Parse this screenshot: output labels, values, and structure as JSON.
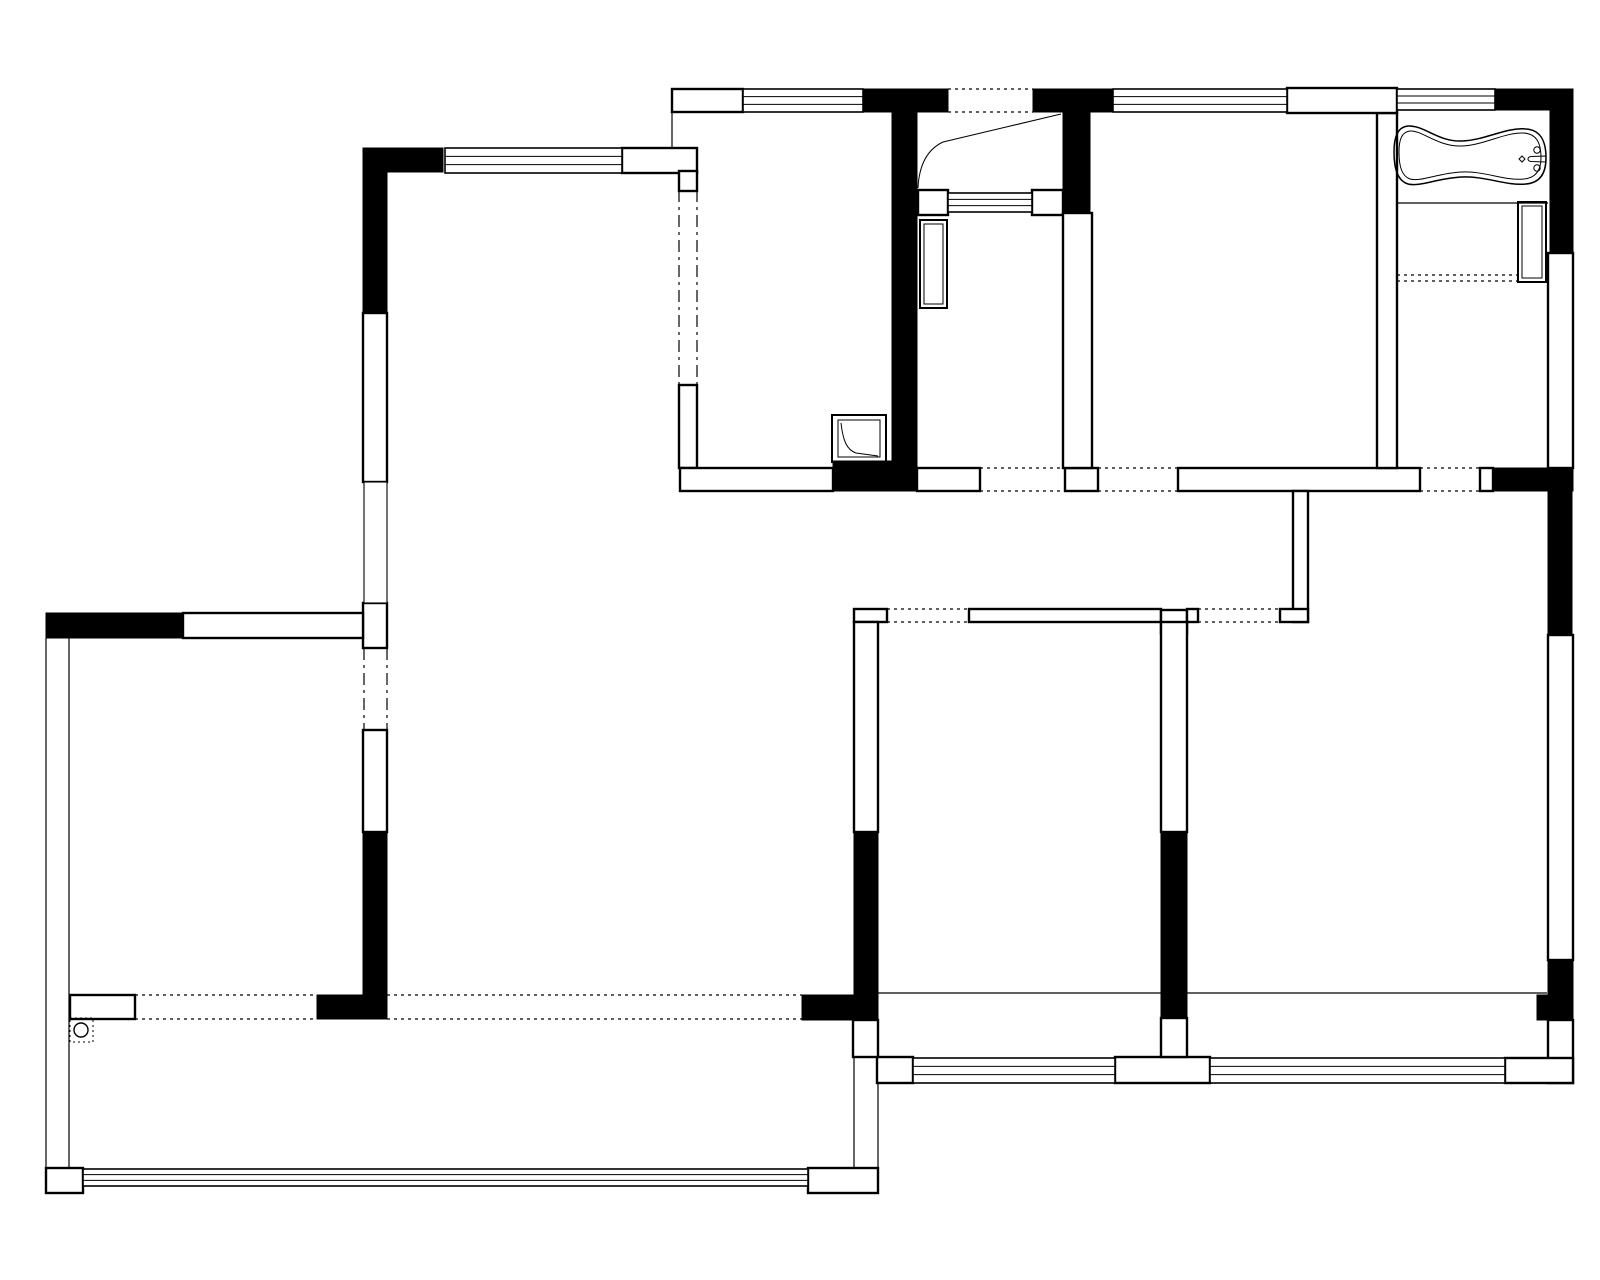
{
  "document": {
    "kind": "architectural-floor-plan",
    "ink_color": "#000000",
    "background_color": "#ffffff",
    "canvas": {
      "width": 1600,
      "height": 1280
    }
  },
  "plan": {
    "black_walls": [
      [
        363,
        148,
        80,
        24
      ],
      [
        363,
        148,
        24,
        165
      ],
      [
        46,
        613,
        137,
        25
      ],
      [
        363,
        832,
        24,
        163
      ],
      [
        317,
        995,
        70,
        24
      ],
      [
        802,
        995,
        76,
        25
      ],
      [
        863,
        89,
        85,
        23
      ],
      [
        1033,
        89,
        80,
        23
      ],
      [
        892,
        112,
        25,
        379
      ],
      [
        833,
        461,
        84,
        30
      ],
      [
        1063,
        112,
        27,
        101
      ],
      [
        1493,
        89,
        80,
        21
      ],
      [
        1550,
        110,
        23,
        143
      ],
      [
        1493,
        468,
        80,
        23
      ],
      [
        1548,
        468,
        24,
        167
      ],
      [
        1548,
        960,
        25,
        60
      ],
      [
        1537,
        995,
        13,
        25
      ],
      [
        854,
        832,
        24,
        188
      ],
      [
        1161,
        832,
        26,
        188
      ]
    ],
    "outline_walls": [
      [
        672,
        89,
        71,
        23
      ],
      [
        622,
        148,
        75,
        25
      ],
      [
        363,
        313,
        24,
        169
      ],
      [
        363,
        603,
        24,
        45
      ],
      [
        363,
        730,
        24,
        102
      ],
      [
        183,
        613,
        180,
        25
      ],
      [
        70,
        995,
        65,
        24
      ],
      [
        46,
        1168,
        37,
        25
      ],
      [
        808,
        1168,
        70,
        25
      ],
      [
        679,
        171,
        18,
        20
      ],
      [
        679,
        385,
        18,
        83
      ],
      [
        680,
        468,
        153,
        23
      ],
      [
        917,
        468,
        63,
        23
      ],
      [
        1065,
        468,
        33,
        23
      ],
      [
        1178,
        468,
        242,
        23
      ],
      [
        1480,
        468,
        13,
        23
      ],
      [
        1377,
        113,
        20,
        355
      ],
      [
        1548,
        253,
        25,
        215
      ],
      [
        1548,
        635,
        25,
        325
      ],
      [
        1548,
        1020,
        25,
        63
      ],
      [
        1505,
        1058,
        68,
        25
      ],
      [
        918,
        190,
        30,
        25
      ],
      [
        1032,
        190,
        31,
        25
      ],
      [
        1063,
        213,
        29,
        255
      ],
      [
        1293,
        491,
        15,
        131
      ],
      [
        1280,
        609,
        28,
        13
      ],
      [
        854,
        609,
        33,
        13
      ],
      [
        969,
        609,
        192,
        13
      ],
      [
        1161,
        610,
        26,
        23
      ],
      [
        1187,
        609,
        11,
        13
      ],
      [
        854,
        622,
        24,
        210
      ],
      [
        1161,
        622,
        26,
        210
      ],
      [
        877,
        1057,
        36,
        26
      ],
      [
        1115,
        1057,
        95,
        26
      ],
      [
        1161,
        1018,
        26,
        39
      ],
      [
        853,
        1020,
        25,
        37
      ],
      [
        1287,
        88,
        110,
        25
      ]
    ],
    "thin_walls": [
      [
        364,
        482,
        23,
        121
      ]
    ],
    "lines": [
      [
        878,
        993,
        1161,
        993
      ],
      [
        1187,
        993,
        1547,
        993
      ],
      [
        1397,
        203,
        1548,
        203
      ],
      [
        854,
        1057,
        854,
        1168
      ],
      [
        878,
        1083,
        878,
        1193
      ],
      [
        46,
        638,
        46,
        1168
      ],
      [
        69,
        638,
        69,
        1168
      ],
      [
        672,
        112,
        672,
        148
      ]
    ],
    "dashed_lines": [
      {
        "p": [
          948,
          89,
          1033,
          89
        ],
        "d": "3,4"
      },
      {
        "p": [
          948,
          112,
          1033,
          112
        ],
        "d": "3,4"
      },
      {
        "p": [
          980,
          468,
          1065,
          468
        ],
        "d": "3,4"
      },
      {
        "p": [
          980,
          491,
          1065,
          491
        ],
        "d": "3,4"
      },
      {
        "p": [
          1098,
          468,
          1178,
          468
        ],
        "d": "3,4"
      },
      {
        "p": [
          1098,
          491,
          1178,
          491
        ],
        "d": "3,4"
      },
      {
        "p": [
          1420,
          468,
          1480,
          468
        ],
        "d": "3,4"
      },
      {
        "p": [
          1420,
          491,
          1480,
          491
        ],
        "d": "3,4"
      },
      {
        "p": [
          887,
          609,
          969,
          609
        ],
        "d": "3,4"
      },
      {
        "p": [
          887,
          622,
          969,
          622
        ],
        "d": "3,4"
      },
      {
        "p": [
          1198,
          609,
          1280,
          609
        ],
        "d": "3,4"
      },
      {
        "p": [
          1198,
          622,
          1280,
          622
        ],
        "d": "3,4"
      },
      {
        "p": [
          135,
          995,
          317,
          995
        ],
        "d": "3,4"
      },
      {
        "p": [
          135,
          1019,
          317,
          1019
        ],
        "d": "3,4"
      },
      {
        "p": [
          387,
          995,
          802,
          995
        ],
        "d": "3,4"
      },
      {
        "p": [
          387,
          1019,
          802,
          1019
        ],
        "d": "3,4"
      },
      {
        "p": [
          1397,
          275,
          1518,
          275
        ],
        "d": "3,4"
      },
      {
        "p": [
          1397,
          281,
          1518,
          281
        ],
        "d": "3,4"
      },
      {
        "p": [
          679,
          190,
          679,
          385
        ],
        "d": "12,5,3,5"
      },
      {
        "p": [
          697,
          190,
          697,
          385
        ],
        "d": "12,5,3,5"
      },
      {
        "p": [
          364,
          648,
          364,
          730
        ],
        "d": "12,5,3,5"
      },
      {
        "p": [
          387,
          648,
          387,
          730
        ],
        "d": "12,5,3,5"
      }
    ],
    "dotted_rects": [
      [
        70,
        1018,
        23,
        24
      ]
    ],
    "windows": [
      [
        445,
        148,
        177,
        25
      ],
      [
        743,
        89,
        120,
        23
      ],
      [
        1113,
        89,
        174,
        23
      ],
      [
        1397,
        89,
        98,
        21
      ],
      [
        83,
        1169,
        725,
        17
      ],
      [
        913,
        1058,
        202,
        25
      ],
      [
        1210,
        1058,
        295,
        25
      ],
      [
        948,
        193,
        84,
        19
      ]
    ],
    "fixtures": [
      {
        "name": "bathtub",
        "type": "path",
        "sw": 1.5,
        "d": "M 1408 126 C 1398 127 1394 136 1394 152 C 1394 170 1398 181 1408 184 C 1420 187 1438 178 1462 177 C 1486 176 1506 186 1526 184 C 1538 183 1546 176 1546 158 C 1546 140 1540 130 1526 129 C 1506 127 1486 140 1462 141 C 1438 142 1424 125 1408 126 Z"
      },
      {
        "name": "bathtub-inner-rim",
        "type": "path",
        "sw": 1,
        "d": "M 1410 131 C 1402 132 1399 139 1399 152 C 1399 167 1402 176 1410 179 C 1421 182 1438 173 1462 172 C 1485 171 1505 181 1524 179 C 1534 178 1541 172 1541 158 C 1541 142 1536 134 1524 133 C 1505 132 1485 145 1462 146 C 1438 147 1422 130 1410 131 Z"
      },
      {
        "name": "bathtub-faucet-spout",
        "type": "path",
        "sw": 1,
        "d": "M 1546 156 L 1531 156.5 C 1527 157 1527 161 1531 161.5 L 1546 162 Z"
      },
      {
        "name": "bathtub-faucet-knob",
        "type": "circle",
        "cx": 1537,
        "cy": 150,
        "r": 3.2,
        "sw": 1
      },
      {
        "name": "bathtub-faucet-knob",
        "type": "circle",
        "cx": 1537,
        "cy": 168,
        "r": 3.2,
        "sw": 1
      },
      {
        "name": "bathtub-drain",
        "type": "path",
        "sw": 1,
        "d": "M 1522 156 l 3 3 l -3 3 l -3 -3 Z"
      },
      {
        "name": "kitchen-appliance",
        "type": "rect",
        "x": 832,
        "y": 415,
        "w": 54,
        "h": 47,
        "sw": 2
      },
      {
        "name": "kitchen-appliance-inner",
        "type": "rect",
        "x": 838,
        "y": 420,
        "w": 42,
        "h": 37,
        "sw": 1
      },
      {
        "name": "kitchen-appliance-curve",
        "type": "path",
        "sw": 1,
        "d": "M 841 423 C 843 441 847 450 856 453 L 878 456"
      },
      {
        "name": "entry-cabinet",
        "type": "rect",
        "x": 920,
        "y": 220,
        "w": 27,
        "h": 88,
        "sw": 2
      },
      {
        "name": "entry-cabinet-inner",
        "type": "rect",
        "x": 924,
        "y": 224,
        "w": 19,
        "h": 80,
        "sw": 1
      },
      {
        "name": "bathroom-counter",
        "type": "rect",
        "x": 1518,
        "y": 202,
        "w": 28,
        "h": 80,
        "sw": 2
      },
      {
        "name": "bathroom-counter-inner",
        "type": "rect",
        "x": 1522,
        "y": 206,
        "w": 20,
        "h": 72,
        "sw": 1
      },
      {
        "name": "floor-drain",
        "type": "circle",
        "cx": 81,
        "cy": 1030,
        "r": 7,
        "sw": 1.4
      },
      {
        "name": "entry-door-swing",
        "type": "path",
        "sw": 1,
        "d": "M 1061 114 L 943 142 C 926 150 919 167 918 188"
      }
    ]
  }
}
